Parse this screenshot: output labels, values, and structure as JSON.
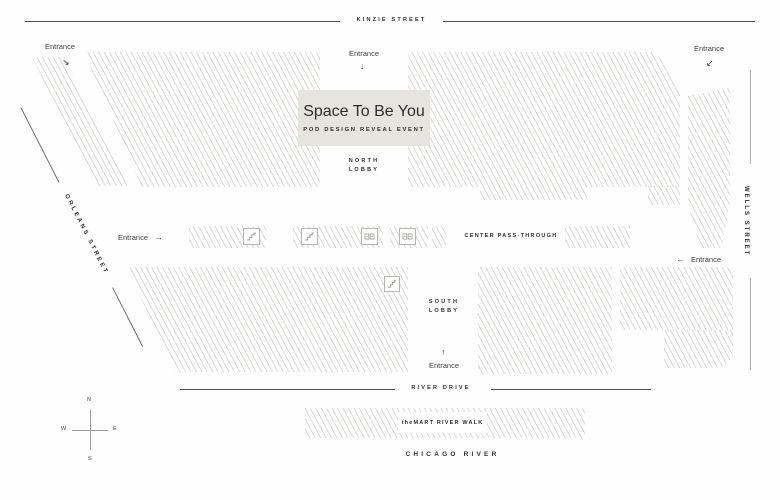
{
  "colors": {
    "hatch": "#dbd9d6",
    "boxbg": "#e6e4df",
    "linedark": "#4f4f4f",
    "linemid": "#b3b1ae",
    "textdark": "#2e2e2e",
    "textsoft": "#3f3f3f"
  },
  "event": {
    "title": "Space To Be You",
    "subtitle": "POD DESIGN REVEAL EVENT"
  },
  "streets": {
    "kinzie": "KINZIE STREET",
    "orleans": "ORLEANS STREET",
    "wells": "WELLS STREET",
    "river_drive": "RIVER DRIVE",
    "chicago_river": "CHICAGO RIVER",
    "riverwalk": "theMART RIVER WALK"
  },
  "areas": {
    "north_lobby_1": "NORTH",
    "north_lobby_2": "LOBBY",
    "south_lobby_1": "SOUTH",
    "south_lobby_2": "LOBBY",
    "pass_through": "CENTER PASS-THROUGH"
  },
  "entrances": {
    "label": "Entrance",
    "nw_arrow": "↘",
    "n_arrow": "↓",
    "ne_arrow": "↙",
    "w_arrow": "→",
    "e_arrow": "←",
    "s_arrow": "↑"
  },
  "compass": {
    "n": "N",
    "s": "S",
    "e": "E",
    "w": "W"
  }
}
